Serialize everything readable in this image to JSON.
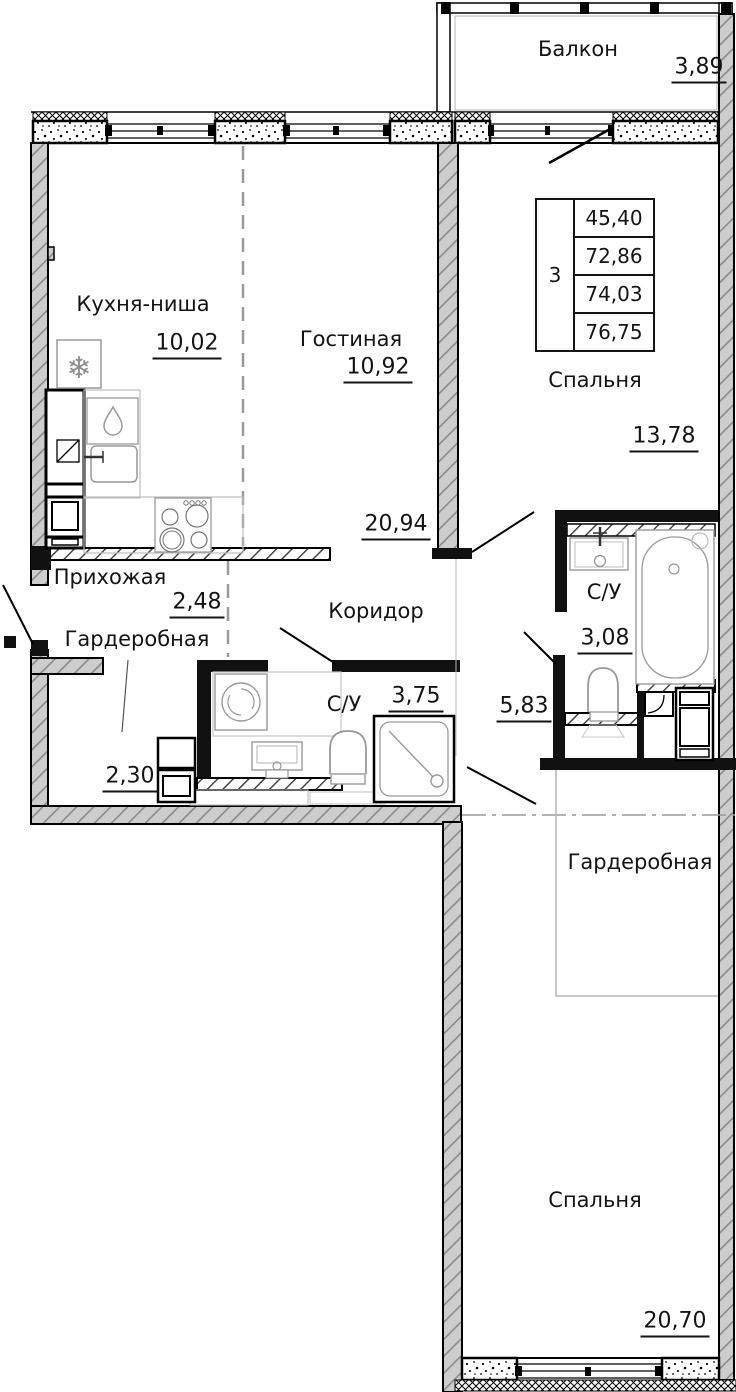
{
  "balcony": {
    "label": "Балкон",
    "area": "3,89"
  },
  "info_table": {
    "room_count": "3",
    "areas": [
      "45,40",
      "72,86",
      "74,03",
      "76,75"
    ]
  },
  "rooms": {
    "kitchen": {
      "label": "Кухня-ниша",
      "area": "10,02"
    },
    "living": {
      "label": "Гостиная",
      "area": "10,92"
    },
    "bedroom1": {
      "label": "Спальня",
      "area": "13,78"
    },
    "kitchen_living_zone": {
      "area": "20,94"
    },
    "corridor": {
      "label": "Коридор"
    },
    "hallway": {
      "label": "Прихожая",
      "area": "2,48"
    },
    "wardrobe1": {
      "label": "Гардеробная",
      "area": "2,30"
    },
    "bath1": {
      "label": "С/У",
      "area": "3,75"
    },
    "bath2": {
      "label": "С/У",
      "area": "3,08"
    },
    "hall2": {
      "area": "5,83"
    },
    "wardrobe2": {
      "label": "Гардеробная"
    },
    "bedroom2": {
      "label": "Спальня",
      "area": "20,70"
    }
  },
  "icons": {
    "snowflake": "❄"
  },
  "colors": {
    "wall_fill": "#cdcdcd",
    "line": "#000000",
    "dash": "#9a9a9a",
    "fixture": "#9a9a9a"
  }
}
